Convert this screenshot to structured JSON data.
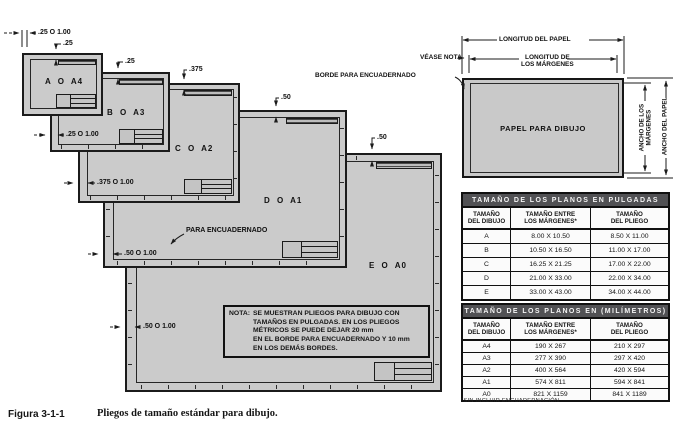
{
  "colors": {
    "sheet_fill": "#cbcbcb",
    "line": "#1b1b1b",
    "table_header_bg": "#515154",
    "table_header_text": "#f4f4f4"
  },
  "sheets": {
    "a": "A O A4",
    "b": "B O A3",
    "c": "C O A2",
    "d": "D O A1",
    "e": "E O A0"
  },
  "dims": {
    "a_left": ".25 O 1.00",
    "a_top": ".25",
    "b_top": ".25",
    "b_left": ".25 O 1.00",
    "c_top": ".375",
    "c_left": ".375 O 1.00",
    "d_top": ".50",
    "d_left": ".50 O 1.00",
    "e_top": ".50",
    "e_left": ".50 O 1.00",
    "binding": "PARA ENCUADERNADO"
  },
  "note": {
    "label": "NOTA:",
    "lines": [
      "SE MUESTRAN PLIEGOS PARA DIBUJO CON",
      "TAMAÑOS EN PULGADAS. EN LOS PLIEGOS",
      "MÉTRICOS SE PUEDE DEJAR 20 mm",
      "EN EL BORDE PARA ENCUADERNADO Y 10 mm",
      "EN LOS DEMÁS BORDES."
    ]
  },
  "paper": {
    "center": "PAPEL PARA DIBUJO",
    "length_paper": "LONGITUD DEL PAPEL",
    "length_margins_1": "LONGITUD DE",
    "length_margins_2": "LOS MÁRGENES",
    "width_margins_1": "ANCHO DE LOS",
    "width_margins_2": "MÁRGENES",
    "width_paper": "ANCHO DEL PAPEL",
    "see_note": "VÉASE NOTA",
    "binding_edge": "BORDE PARA ENCUADERNADO"
  },
  "tables": {
    "inches": {
      "title": "TAMAÑO DE LOS PLANOS EN PULGADAS",
      "headers": [
        [
          "TAMAÑO",
          "DEL DIBUJO"
        ],
        [
          "TAMAÑO ENTRE",
          "LOS MÁRGENES*"
        ],
        [
          "TAMAÑO",
          "DEL PLIEGO"
        ]
      ],
      "rows": [
        [
          "A",
          "8.00 X 10.50",
          "8.50 X 11.00"
        ],
        [
          "B",
          "10.50 X 16.50",
          "11.00 X 17.00"
        ],
        [
          "C",
          "16.25 X 21.25",
          "17.00 X 22.00"
        ],
        [
          "D",
          "21.00 X 33.00",
          "22.00 X 34.00"
        ],
        [
          "E",
          "33.00 X 43.00",
          "34.00 X 44.00"
        ]
      ]
    },
    "mm": {
      "title": "TAMAÑO DE LOS PLANOS EN (MILÍMETROS)",
      "headers": [
        [
          "TAMAÑO",
          "DEL DIBUJO"
        ],
        [
          "TAMAÑO ENTRE",
          "LOS MÁRGENES*"
        ],
        [
          "TAMAÑO",
          "DEL PLIEGO"
        ]
      ],
      "rows": [
        [
          "A4",
          "190 X 267",
          "210 X 297"
        ],
        [
          "A3",
          "277 X 390",
          "297 X 420"
        ],
        [
          "A2",
          "400 X 564",
          "420 X 594"
        ],
        [
          "A1",
          "574 X 811",
          "594 X 841"
        ],
        [
          "A0",
          "821 X 1159",
          "841 X 1189"
        ]
      ]
    }
  },
  "footnote": "*SIN INCLUIR ENCUADERNACIÓN",
  "caption": {
    "number": "Figura 3-1-1",
    "text": "Pliegos de tamaño estándar para dibujo."
  }
}
